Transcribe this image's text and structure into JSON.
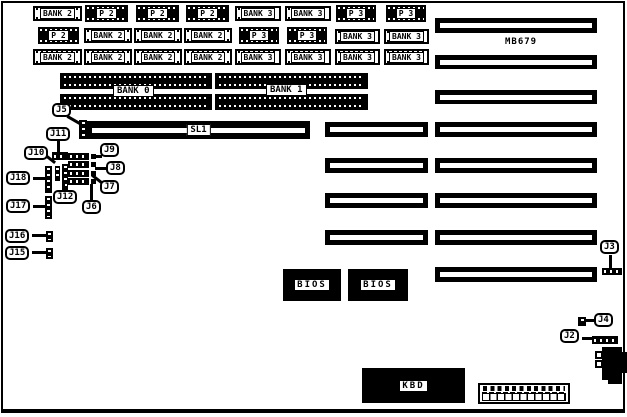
{
  "colors": {
    "ink": "#000000",
    "paper": "#ffffff"
  },
  "board": {
    "model_label": "MB679"
  },
  "memory_chips": [
    {
      "label": "BANK 2"
    },
    {
      "label": "P 2"
    },
    {
      "label": "P 2"
    },
    {
      "label": "P 2"
    },
    {
      "label": "BANK 3"
    },
    {
      "label": "BANK 3"
    },
    {
      "label": "P 3"
    },
    {
      "label": "P 3"
    },
    {
      "label": "P 2"
    },
    {
      "label": "BANK 2"
    },
    {
      "label": "BANK 2"
    },
    {
      "label": "BANK 2"
    },
    {
      "label": "P 3"
    },
    {
      "label": "P 3"
    },
    {
      "label": "BANK 3"
    },
    {
      "label": "BANK 3"
    },
    {
      "label": "BANK 2"
    },
    {
      "label": "BANK 2"
    },
    {
      "label": "BANK 2"
    },
    {
      "label": "BANK 2"
    },
    {
      "label": "BANK 3"
    },
    {
      "label": "BANK 3"
    },
    {
      "label": "BANK 3"
    },
    {
      "label": "BANK 3"
    }
  ],
  "simm_banks": {
    "bank0": "BANK 0",
    "bank1": "BANK 1"
  },
  "slots": {
    "sl1": "SL1"
  },
  "ics": {
    "bios1": "BIOS",
    "bios2": "BIOS",
    "kbd": "KBD"
  },
  "jumpers": {
    "j2": "J2",
    "j3": "J3",
    "j4": "J4",
    "j5": "J5",
    "j6": "J6",
    "j7": "J7",
    "j8": "J8",
    "j9": "J9",
    "j10": "J10",
    "j11": "J11",
    "j12": "J12",
    "j15": "J15",
    "j16": "J16",
    "j17": "J17",
    "j18": "J18"
  }
}
